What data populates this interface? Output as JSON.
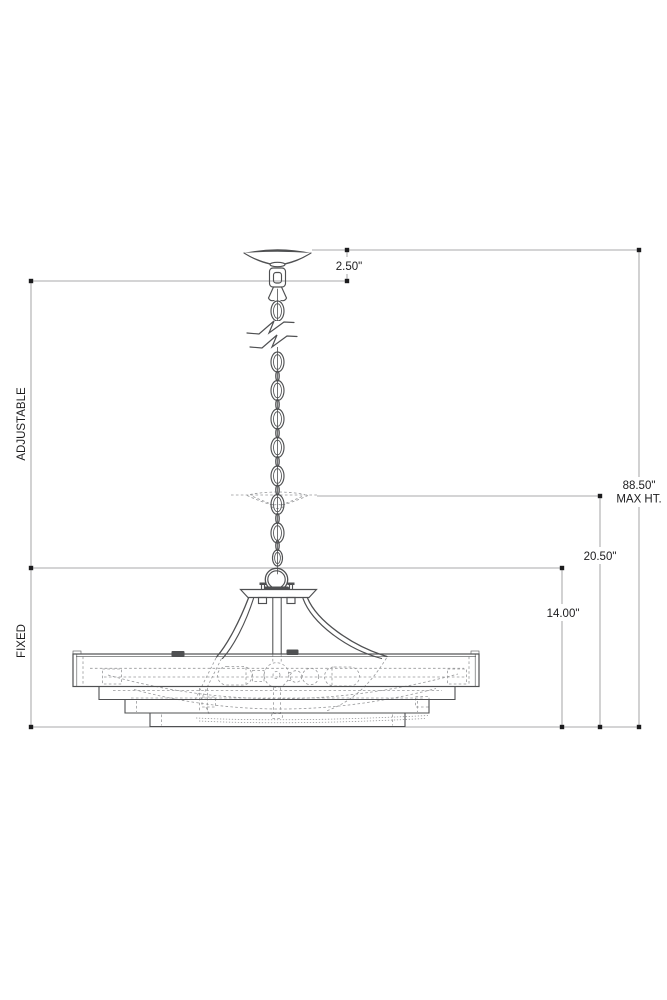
{
  "drawing": {
    "kind": "pendant-light-fixture-dimension-diagram",
    "labels": {
      "canopy_height": "2.50\"",
      "max_height": "88.50\"",
      "max_height_note": "MAX HT.",
      "min_overall_drop": "20.50\"",
      "fixture_height": "14.00\"",
      "chain_section": "ADJUSTABLE",
      "body_section": "FIXED"
    },
    "colors": {
      "background": "#ffffff",
      "outline": "#4f5052",
      "hidden_line": "#97989a",
      "dimension_line": "#8d8d8f",
      "text": "#1c1c1e"
    }
  }
}
